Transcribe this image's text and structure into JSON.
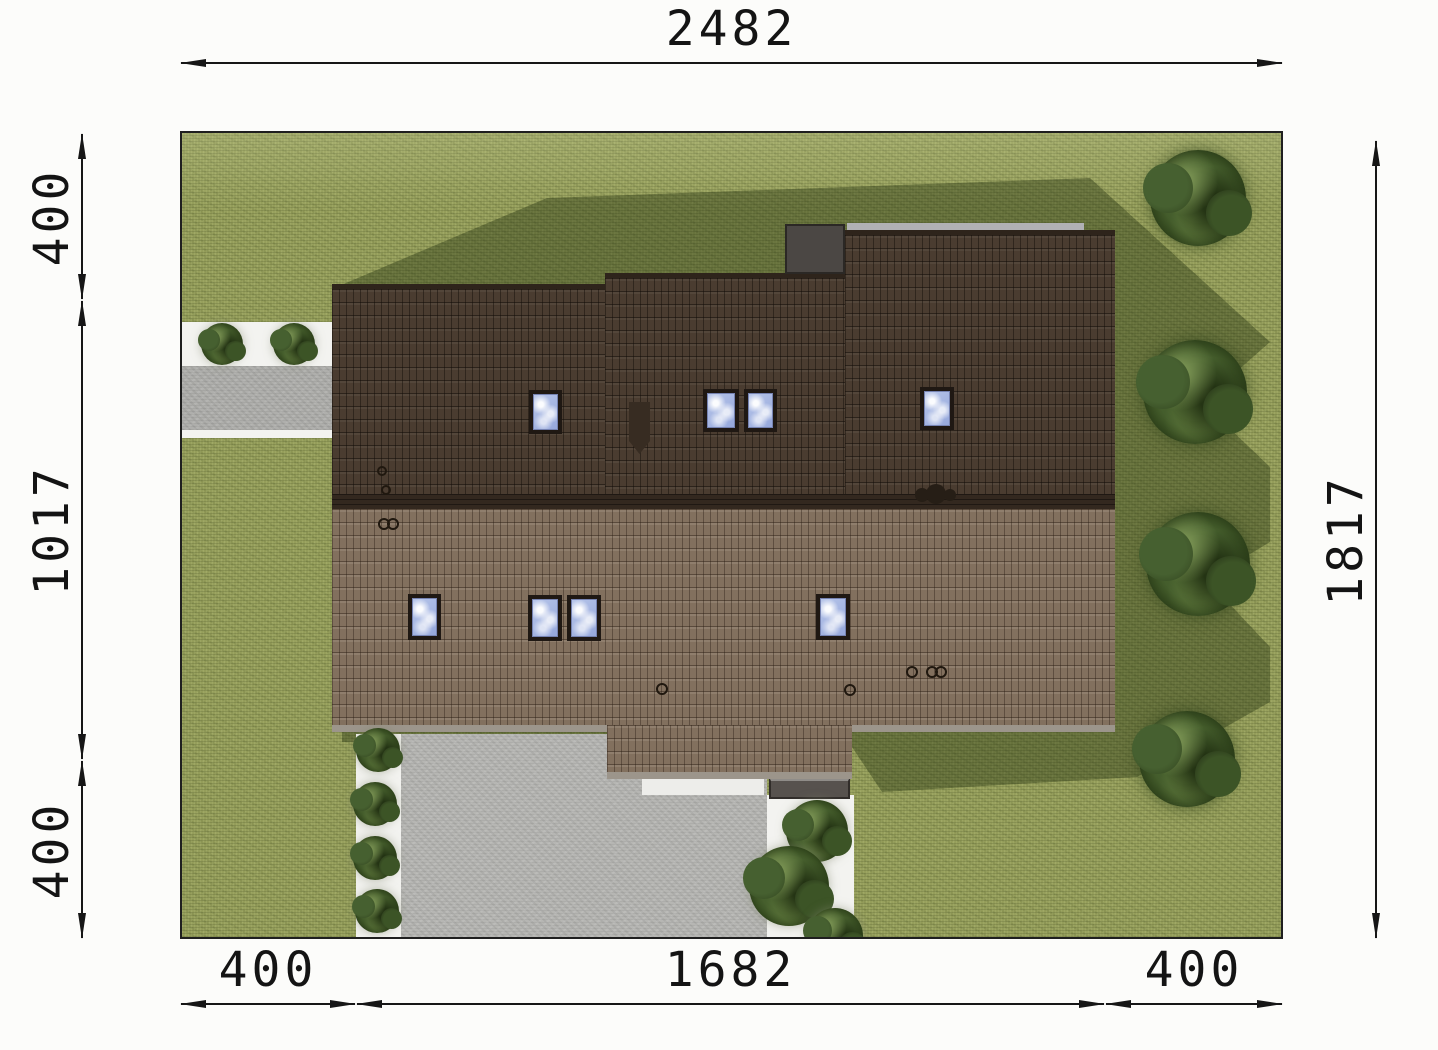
{
  "document": {
    "type": "architectural site plan, top view of house on plot",
    "background_color": "#fcfcfa"
  },
  "dimensions": {
    "top": {
      "y": 63,
      "segments": [
        {
          "label": "2482",
          "from": 180,
          "to": 1283
        }
      ]
    },
    "bottom": {
      "y": 1004,
      "segments": [
        {
          "label": "400",
          "from": 180,
          "to": 356
        },
        {
          "label": "1682",
          "from": 356,
          "to": 1105
        },
        {
          "label": "400",
          "from": 1105,
          "to": 1283
        }
      ]
    },
    "left": {
      "x": 82,
      "segments": [
        {
          "label": "400",
          "from": 133,
          "to": 300
        },
        {
          "label": "1017",
          "from": 300,
          "to": 760
        },
        {
          "label": "400",
          "from": 760,
          "to": 939
        }
      ]
    },
    "right": {
      "x": 1376,
      "segments": [
        {
          "label": "1817",
          "from": 140,
          "to": 939
        }
      ]
    }
  },
  "plot": {
    "x": 180,
    "y": 131,
    "width": 1103,
    "height": 808
  },
  "plan": {
    "roof_windows_upper_slope": [
      {
        "x": 347,
        "y": 257,
        "w": 33,
        "h": 44
      },
      {
        "x": 521,
        "y": 256,
        "w": 36,
        "h": 43
      },
      {
        "x": 562,
        "y": 256,
        "w": 33,
        "h": 43
      },
      {
        "x": 738,
        "y": 254,
        "w": 34,
        "h": 43
      }
    ],
    "roof_windows_lower_slope": [
      {
        "x": 226,
        "y": 461,
        "w": 33,
        "h": 46
      },
      {
        "x": 346,
        "y": 462,
        "w": 34,
        "h": 46
      },
      {
        "x": 385,
        "y": 462,
        "w": 34,
        "h": 46
      },
      {
        "x": 634,
        "y": 461,
        "w": 34,
        "h": 46
      }
    ],
    "trees_along_right_edge": [
      {
        "cx": 1016,
        "cy": 65,
        "r": 48
      },
      {
        "cx": 1013,
        "cy": 259,
        "r": 52
      },
      {
        "cx": 1016,
        "cy": 431,
        "r": 52
      },
      {
        "cx": 1005,
        "cy": 626,
        "r": 48
      }
    ],
    "bushes": [
      {
        "cx": 40,
        "cy": 211,
        "r": 21
      },
      {
        "cx": 112,
        "cy": 211,
        "r": 21
      },
      {
        "cx": 196,
        "cy": 617,
        "r": 22
      },
      {
        "cx": 193,
        "cy": 671,
        "r": 22
      },
      {
        "cx": 193,
        "cy": 725,
        "r": 22
      },
      {
        "cx": 195,
        "cy": 778,
        "r": 22
      },
      {
        "cx": 635,
        "cy": 698,
        "r": 31
      },
      {
        "cx": 607,
        "cy": 753,
        "r": 40
      },
      {
        "cx": 653,
        "cy": 803,
        "r": 28
      }
    ],
    "ridge_ornaments": [
      {
        "cx": 740,
        "cy": 362,
        "r": 7
      },
      {
        "cx": 754,
        "cy": 361,
        "r": 10
      },
      {
        "cx": 768,
        "cy": 362,
        "r": 6
      }
    ],
    "roof_detail_rings": [
      {
        "cx": 200,
        "cy": 389,
        "r": 4
      },
      {
        "cx": 209,
        "cy": 389,
        "r": 4
      },
      {
        "cx": 198,
        "cy": 336,
        "r": 3
      },
      {
        "cx": 202,
        "cy": 355,
        "r": 3
      },
      {
        "cx": 478,
        "cy": 554,
        "r": 4
      },
      {
        "cx": 666,
        "cy": 555,
        "r": 4
      },
      {
        "cx": 728,
        "cy": 537,
        "r": 4
      },
      {
        "cx": 748,
        "cy": 537,
        "r": 4
      },
      {
        "cx": 757,
        "cy": 537,
        "r": 4
      }
    ]
  },
  "colors": {
    "lawn": "#949D5A",
    "lawn_shadow": "rgba(25,38,8,0.36)",
    "roof_upper_slope": "#4A3C30",
    "roof_lower_slope": "#82705E",
    "roof_ridge": "#33281F",
    "driveway": "#B6B6B3",
    "walkway": "#F3F3F0",
    "skylight_glass": "#9FB2E2",
    "tree_canopy": "#3B5224",
    "dimension_ink": "#161616"
  }
}
